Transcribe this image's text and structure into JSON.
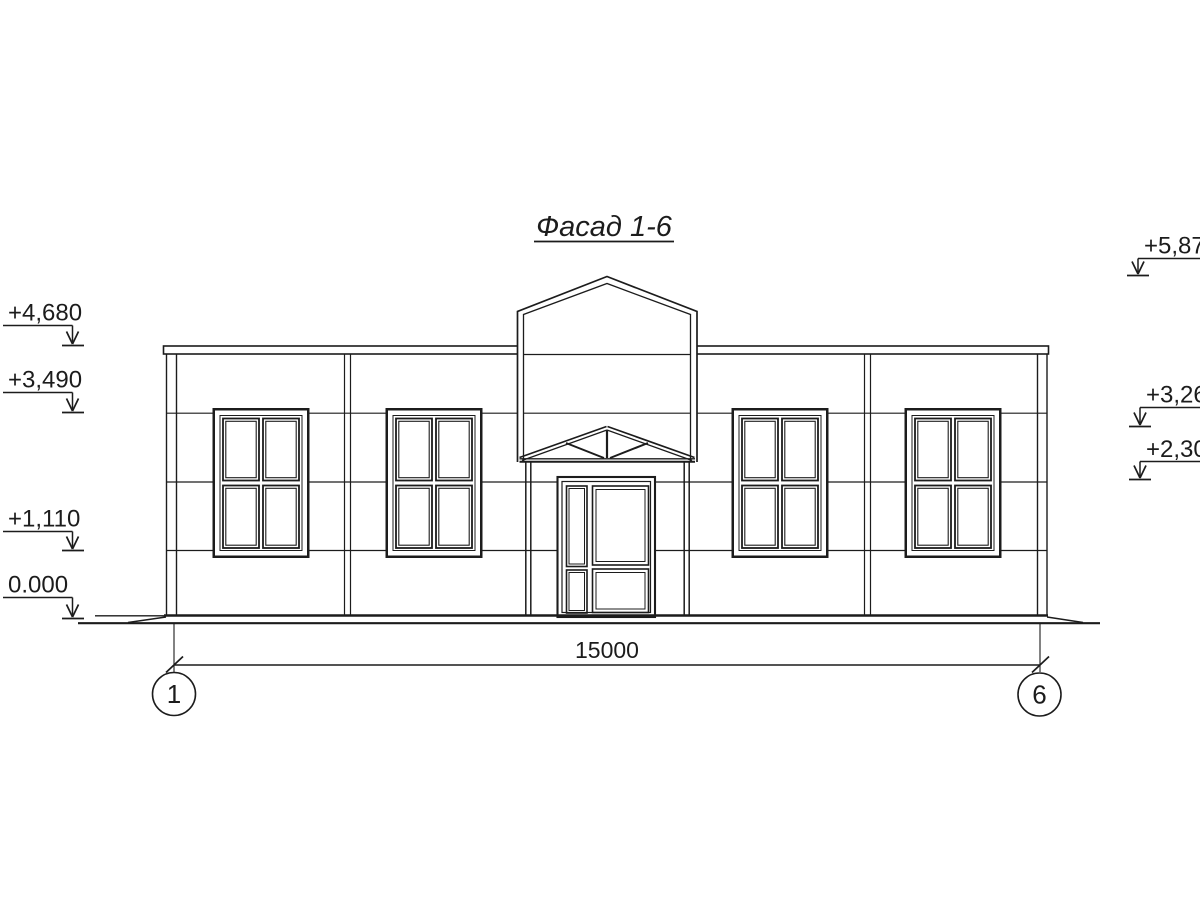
{
  "title": "Фасад 1-6",
  "marks_left": [
    {
      "label": "+4,680"
    },
    {
      "label": "+3,490"
    },
    {
      "label": "+1,110"
    },
    {
      "label": "0.000"
    }
  ],
  "marks_right": [
    {
      "label": "+5,870"
    },
    {
      "label": "+3,260"
    },
    {
      "label": "+2,300"
    }
  ],
  "dimension_label": "15000",
  "axis_left": "1",
  "axis_right": "6",
  "line_color": "#1c1c1c",
  "background_color": "#ffffff"
}
